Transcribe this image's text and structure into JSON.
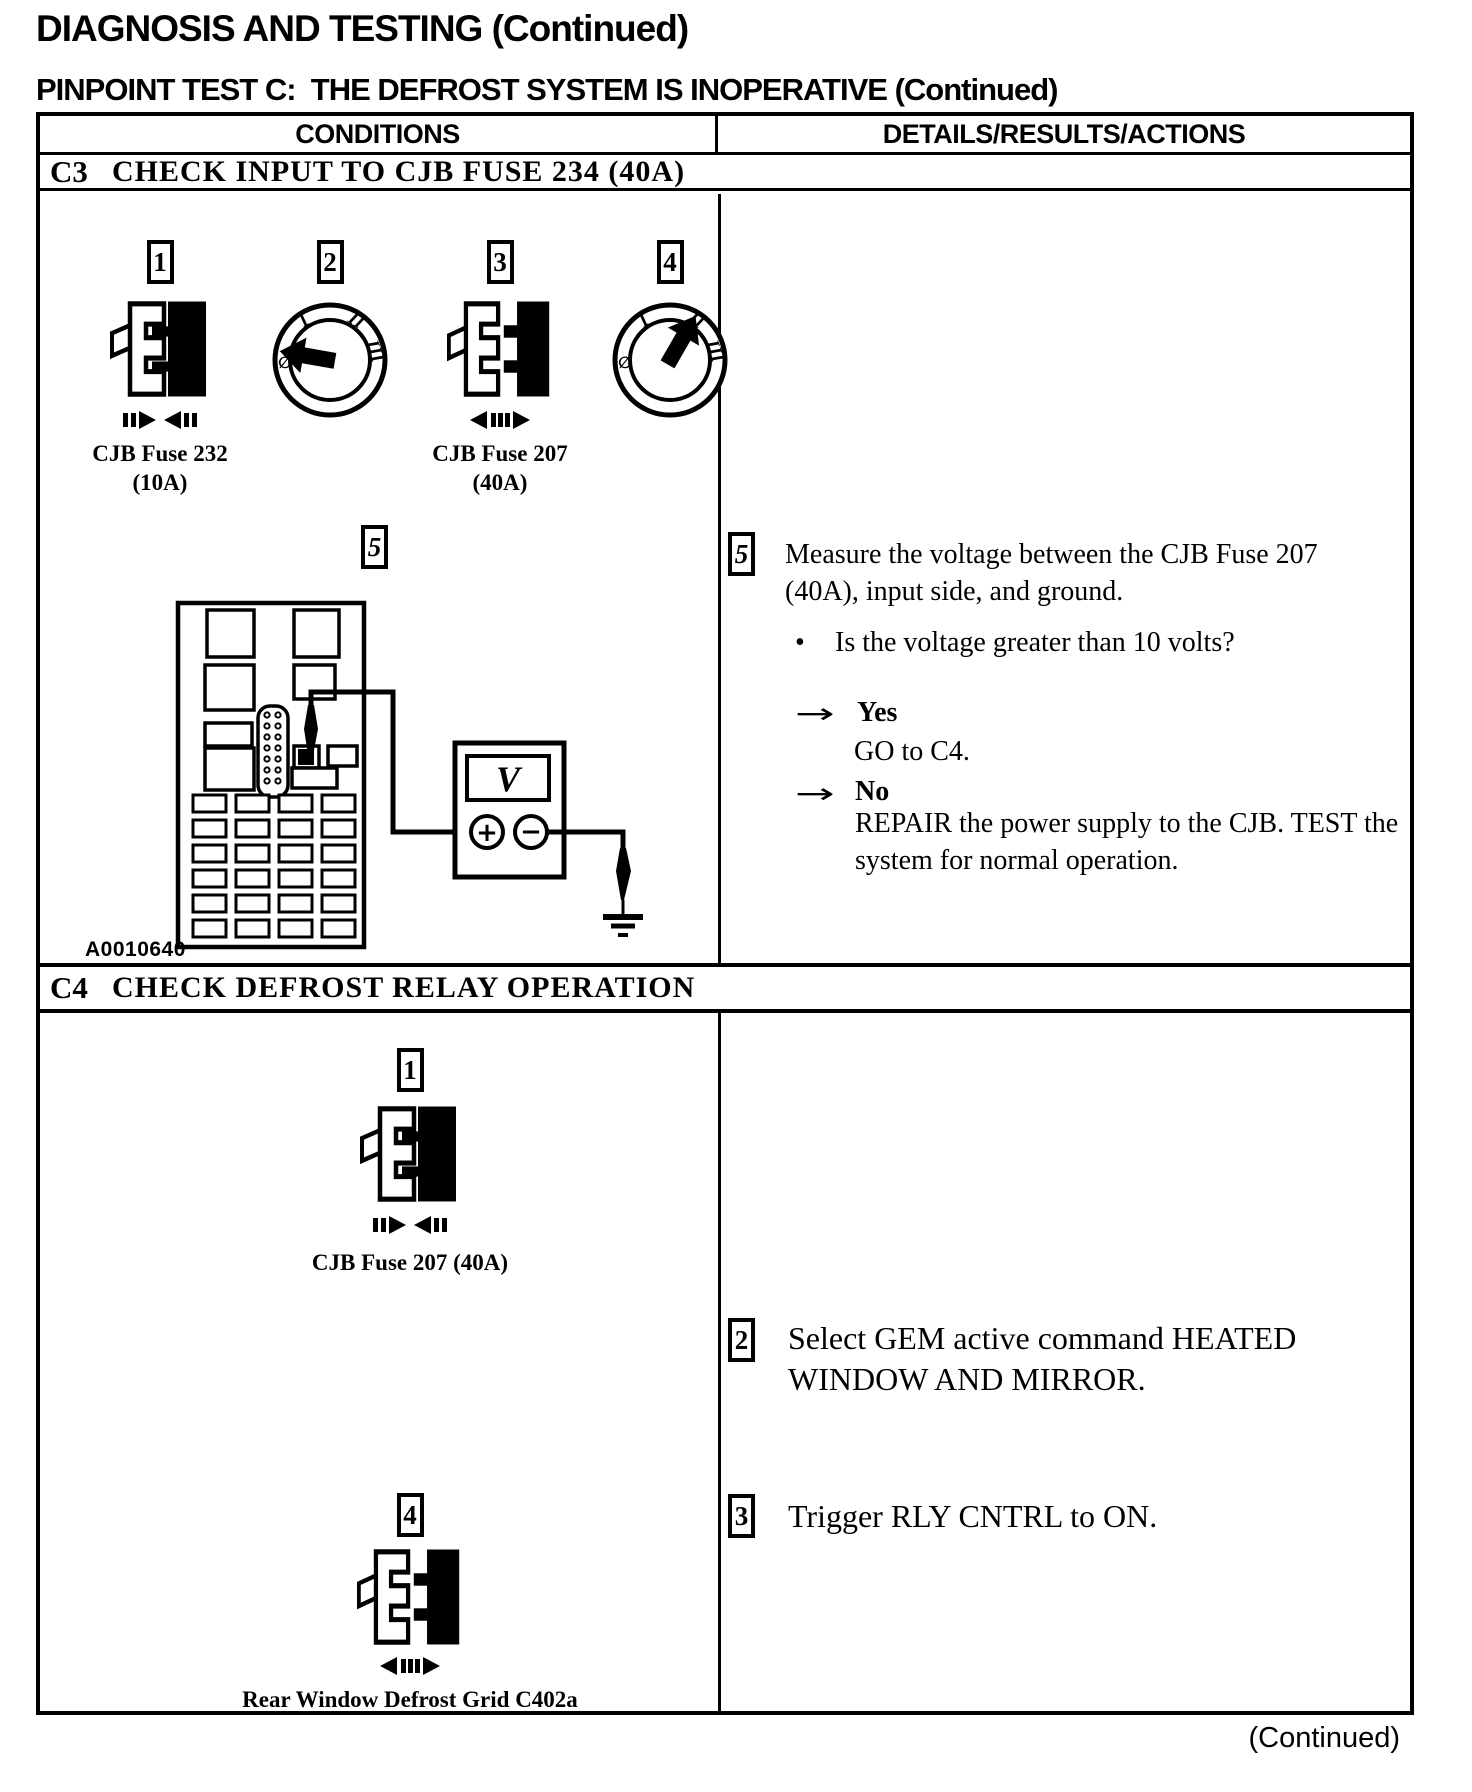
{
  "page": {
    "title": "DIAGNOSIS AND TESTING (Continued)",
    "subtitle": "PINPOINT TEST C:  THE DEFROST SYSTEM IS INOPERATIVE (Continued)",
    "continued": "(Continued)"
  },
  "table": {
    "col_conditions": "CONDITIONS",
    "col_details": "DETAILS/RESULTS/ACTIONS"
  },
  "ignition": {
    "off": "∅",
    "acc": "I",
    "run": "II",
    "start": "III"
  },
  "meter": {
    "display": "V",
    "plus": "+",
    "minus": "−"
  },
  "c3": {
    "id": "C3",
    "title": "CHECK INPUT TO CJB FUSE 234 (40A)",
    "step1": "1",
    "step2": "2",
    "step3": "3",
    "step4": "4",
    "step5": "5",
    "fuse232_line1": "CJB Fuse 232",
    "fuse232_line2": "(10A)",
    "fuse207_line1": "CJB Fuse 207",
    "fuse207_line2": "(40A)",
    "figure_id": "A0010640",
    "action5_num": "5",
    "action5": "Measure the voltage between the CJB Fuse 207 (40A), input side, and ground.",
    "bullet": "•",
    "question": "Is the voltage greater than 10 volts?",
    "arrow": "→",
    "yes_label": "Yes",
    "yes_action": "GO to C4.",
    "no_label": "No",
    "no_action": "REPAIR the power supply to the CJB. TEST the system for normal operation."
  },
  "c4": {
    "id": "C4",
    "title": "CHECK DEFROST RELAY OPERATION",
    "step1": "1",
    "fuse_label": "CJB Fuse 207 (40A)",
    "step4": "4",
    "grid_label": "Rear Window Defrost Grid C402a",
    "action2_num": "2",
    "action2": "Select GEM active command HEATED WINDOW AND MIRROR.",
    "action3_num": "3",
    "action3": "Trigger RLY CNTRL to ON."
  }
}
